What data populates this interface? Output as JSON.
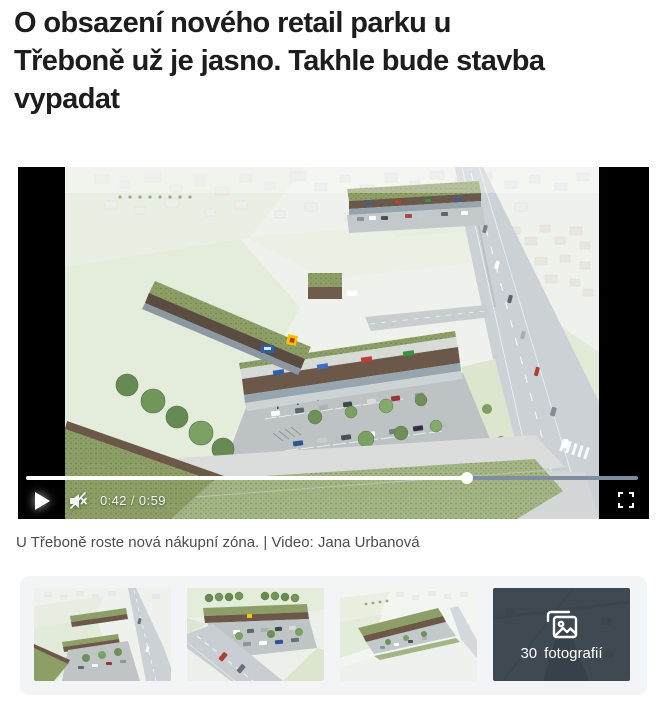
{
  "article": {
    "title": "O obsazení nového retail parku u Třeboně už je jasno. Takhle bude stavba vypadat",
    "title_lines": [
      "O obsazení nového retail parku u",
      "Třeboně už je jasno. Takhle bude stavba",
      "vypadat"
    ]
  },
  "video": {
    "current_time": "0:42",
    "time_separator": "/",
    "duration": "0:59",
    "progress_percent": 72,
    "is_muted": true,
    "is_paused": true,
    "icons": {
      "play": "play-triangle",
      "mute": "muted-speaker",
      "fullscreen": "corner-brackets"
    },
    "colors": {
      "progress_played": "#ffffff",
      "progress_remaining": "#7e8da0",
      "letterbox": "#000000"
    }
  },
  "caption": {
    "text": "U Třeboně roste nová nákupní zóna. | Video: Jana Urbanová"
  },
  "gallery": {
    "background": "#f3f4f6",
    "thumbnail_count": 3,
    "more_tile": {
      "count": "30",
      "label": "fotografií",
      "background": "#3e4952",
      "icon": "photo-stack"
    }
  }
}
